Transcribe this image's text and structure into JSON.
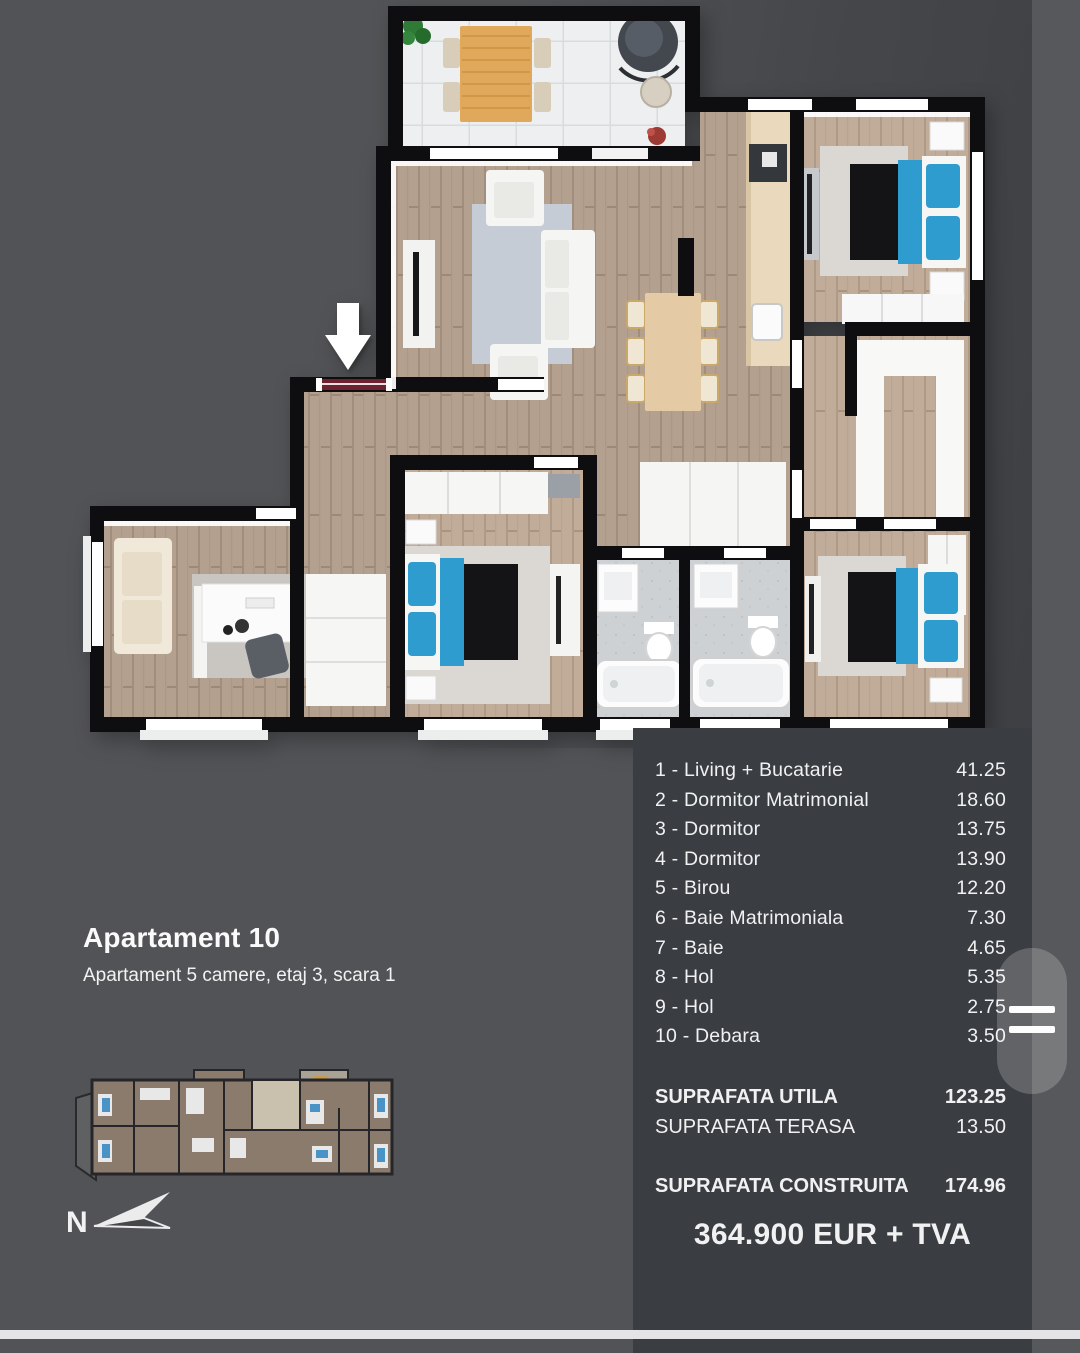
{
  "page": {
    "background": "#515356",
    "panel_background": "#3a3d42",
    "text_color": "#f1f1f2",
    "accent_blue": "#2f9cd0",
    "wood_floor": "#b3a08e",
    "wall_color": "#0e0e10"
  },
  "header": {
    "title": "Apartament 10",
    "subtitle": "Apartament 5 camere, etaj 3, scara 1"
  },
  "rooms": {
    "items": [
      {
        "label": "1 - Living + Bucatarie",
        "value": "41.25"
      },
      {
        "label": "2 - Dormitor Matrimonial",
        "value": "18.60"
      },
      {
        "label": "3 - Dormitor",
        "value": "13.75"
      },
      {
        "label": "4 - Dormitor",
        "value": "13.90"
      },
      {
        "label": "5 - Birou",
        "value": "12.20"
      },
      {
        "label": "6 - Baie Matrimoniala",
        "value": "7.30"
      },
      {
        "label": "7 - Baie",
        "value": "4.65"
      },
      {
        "label": "8 - Hol",
        "value": "5.35"
      },
      {
        "label": "9 - Hol",
        "value": "2.75"
      },
      {
        "label": "10 - Debara",
        "value": "3.50"
      }
    ]
  },
  "totals": [
    {
      "label": "SUPRAFATA UTILA",
      "value": "123.25"
    },
    {
      "label": "SUPRAFATA TERASA",
      "value": "13.50"
    },
    {
      "label": "SUPRAFATA CONSTRUITA",
      "value": "174.96"
    }
  ],
  "price": "364.900 EUR + TVA",
  "compass": {
    "label": "N"
  }
}
